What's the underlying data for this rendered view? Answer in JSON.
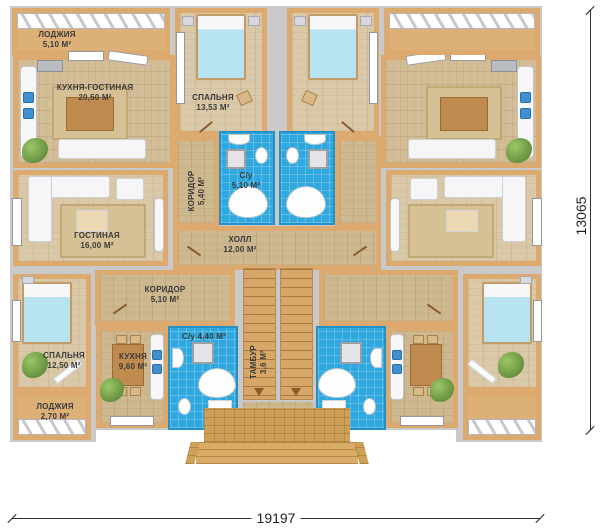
{
  "rooms": {
    "loggia_top": {
      "name": "ЛОДЖИЯ",
      "area": "5,10 М²"
    },
    "kitchen_living": {
      "name": "КУХНЯ-ГОСТИНАЯ",
      "area": "20,50 М²"
    },
    "bedroom_top": {
      "name": "СПАЛЬНЯ",
      "area": "13,53 М²"
    },
    "corridor_top": {
      "name": "КОРИДОР",
      "area": "5,40 М²"
    },
    "wc_top": {
      "name": "С/у",
      "area": "5,10 М²"
    },
    "living_room": {
      "name": "ГОСТИНАЯ",
      "area": "16,00 М²"
    },
    "hall": {
      "name": "ХОЛЛ",
      "area": "12,00 М²"
    },
    "corridor_bottom": {
      "name": "КОРИДОР",
      "area": "5,10 М²"
    },
    "bedroom_bottom": {
      "name": "СПАЛЬНЯ",
      "area": "12,50 М²"
    },
    "kitchen_bottom": {
      "name": "КУХНЯ",
      "area": "9,60 М²"
    },
    "wc_bottom": {
      "name": "С/у",
      "area": "4,40 М²"
    },
    "tambour": {
      "name": "ТАМБУР",
      "area": "3,6 М²"
    },
    "loggia_bottom": {
      "name": "ЛОДЖИЯ",
      "area": "2,70 М²"
    }
  },
  "dimensions": {
    "width": "19197",
    "height": "13065"
  },
  "colors": {
    "wall_gray": "#c9c9c9",
    "wall_accent": "#dcaa6e",
    "floor_wood": "#d8c5a0",
    "bathroom_blue": "#2fa8df",
    "bed_blanket": "#b7e3f1",
    "porch_brick": "#d3a45f"
  }
}
